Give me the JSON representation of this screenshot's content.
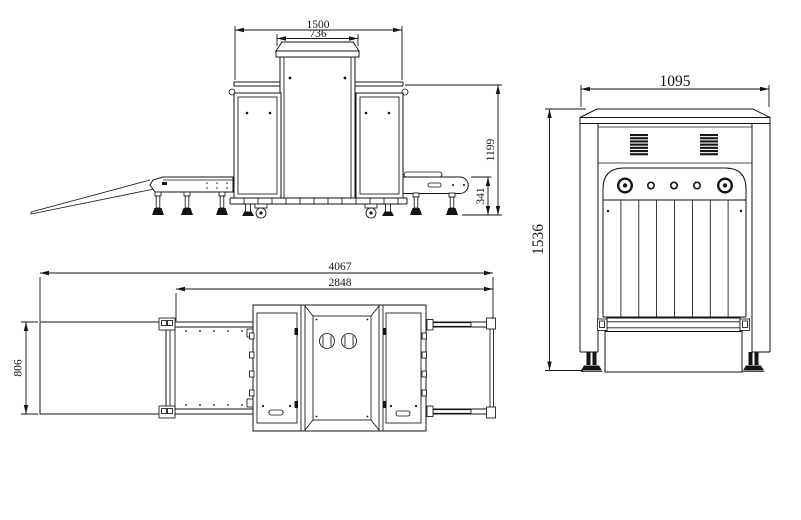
{
  "colors": {
    "line": "#141414",
    "background": "#ffffff",
    "dark_fill": "#111111"
  },
  "views": {
    "front_elevation": {
      "dims": {
        "overall_width": "1500",
        "hood_width": "736",
        "frame_height": "1199",
        "conveyor_height": "341"
      }
    },
    "plan_view": {
      "dims": {
        "overall_length": "4067",
        "machine_length": "2848",
        "conveyor_width": "806"
      }
    },
    "side_elevation": {
      "dims": {
        "overall_width": "1095",
        "overall_height": "1536"
      }
    }
  }
}
